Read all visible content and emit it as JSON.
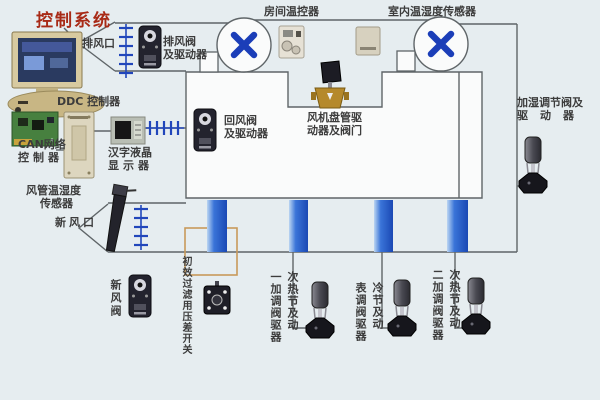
{
  "title": "控制系统",
  "control_station": {
    "ddc_label": "DDC 控制器",
    "can_label_line1": "CAN网络",
    "can_label_line2": "控制器",
    "lcd_label_line1": "汉字液晶",
    "lcd_label_line2": "显示器"
  },
  "air_side": {
    "exhaust_outlet": "排风口",
    "exhaust_valve_line1": "排风阀",
    "exhaust_valve_line2": "及驱动器",
    "room_thermostat": "房间温控器",
    "indoor_sensor": "室内温湿度传感器",
    "return_valve_line1": "回风阀",
    "return_valve_line2": "及驱动器",
    "fan_coil_line1": "风机盘管驱",
    "fan_coil_line2": "动器及阀门",
    "duct_sensor_line1": "风管温湿度",
    "duct_sensor_line2": "传感器",
    "fresh_outlet": "新风口",
    "fresh_valve": "新风阀",
    "filter_switch": "初效过滤用压差开关",
    "humidifier_line1": "加湿调节阀及",
    "humidifier_line2": "驱动器"
  },
  "bottom_valves": [
    {
      "full": "一次加热调节阀及驱动器",
      "col_left": "一加调阀驱器",
      "col_right": "次热节及动"
    },
    {
      "full": "表冷调节阀及驱动器",
      "col_left": "表调阀驱器",
      "col_right": "冷节及动"
    },
    {
      "full": "二次加热调节阀及驱动器",
      "col_left": "二加调阀驱器",
      "col_right": "次热节及动"
    }
  ],
  "colors": {
    "accent_blue": "#1b3eb8",
    "coil_blue": "#2258c8",
    "title_red": "#a82a16",
    "filter_frame_tan": "#c89a5a",
    "line_gray": "#5f6568"
  }
}
